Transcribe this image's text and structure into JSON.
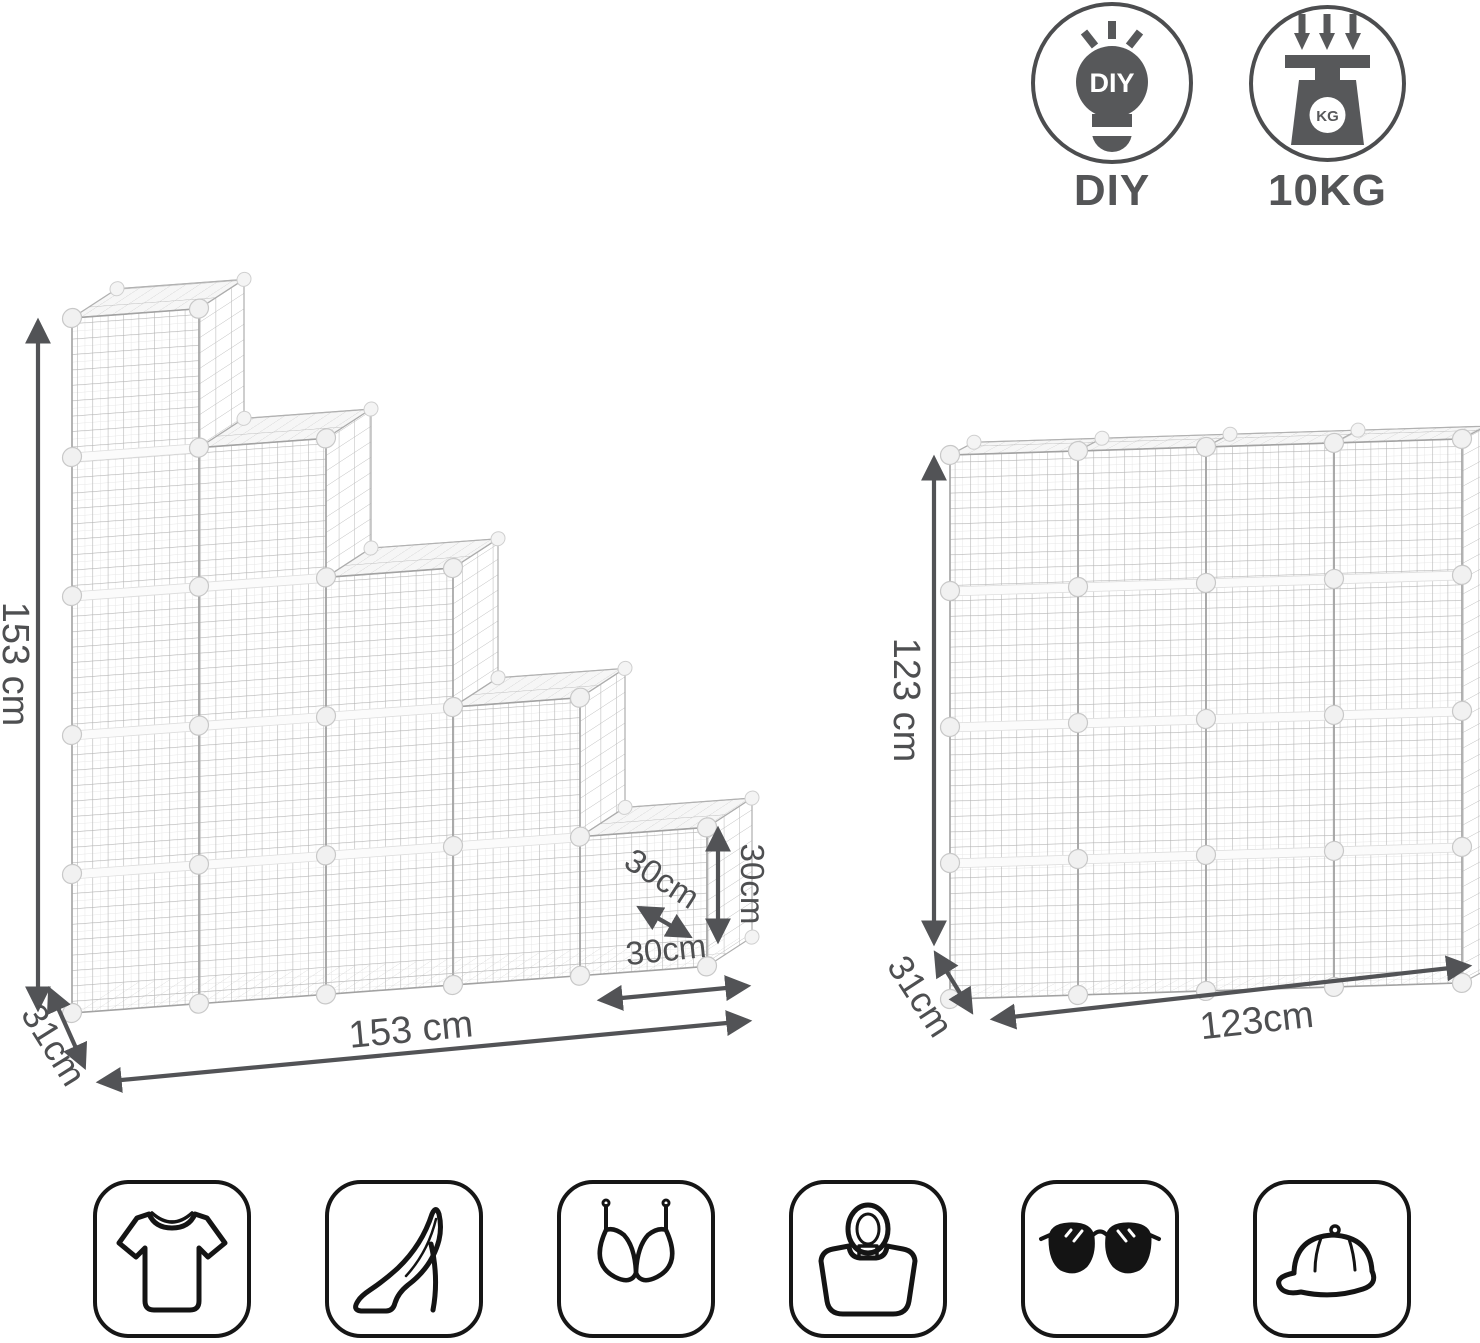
{
  "badges": {
    "diy": {
      "label": "DIY",
      "bulb_text": "DIY"
    },
    "load": {
      "label": "10KG",
      "scale_text": "KG"
    }
  },
  "left_unit": {
    "description": "staircase 15-cube wire storage shelf",
    "height_label": "153 cm",
    "depth_label": "31cm",
    "width_label": "153 cm",
    "cube_width_label": "30cm",
    "cube_depth_label": "30cm",
    "cube_height_label": "30cm"
  },
  "right_unit": {
    "description": "4x4 16-cube wire storage shelf",
    "height_label": "123 cm",
    "depth_label": "31cm",
    "width_label": "123cm"
  },
  "storage_icons": [
    {
      "name": "tshirt-icon"
    },
    {
      "name": "high-heel-icon"
    },
    {
      "name": "bra-icon"
    },
    {
      "name": "handbag-icon"
    },
    {
      "name": "sunglasses-icon"
    },
    {
      "name": "cap-icon"
    }
  ],
  "colors": {
    "annotation": "#525356",
    "icon_dark": "#57585a",
    "wire": "#b4b4b4",
    "outline": "#141414"
  }
}
